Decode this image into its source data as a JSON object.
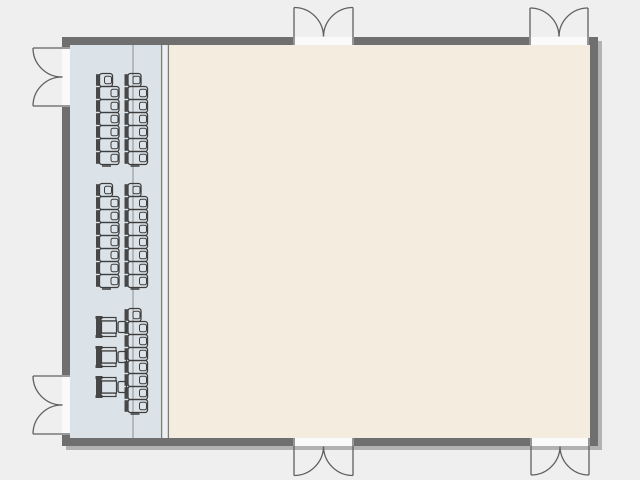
{
  "plan": {
    "canvas": {
      "width": 640,
      "height": 480,
      "background_color": "#efefef"
    },
    "room": {
      "outer": {
        "x": 62,
        "y": 37,
        "width": 536,
        "height": 409
      },
      "wall_thickness": 8,
      "wall_color": "#6f6f6f",
      "shadow": {
        "dx": 4,
        "dy": 4,
        "color": "#b2b2b2"
      }
    },
    "areas": {
      "chair_storage_strip": {
        "x": 70,
        "y": 45,
        "width": 91,
        "height": 393,
        "color": "#dce3e8"
      },
      "partition_band": {
        "x": 161,
        "y": 45,
        "width": 8,
        "height": 393,
        "color": "#edf0f2",
        "edge_color": "#7d7d7d"
      },
      "main_hall": {
        "x": 169,
        "y": 45,
        "width": 421,
        "height": 393,
        "color": "#f4ecdf"
      },
      "strip_divider_line": {
        "x": 133,
        "color": "#8f8f8f"
      }
    },
    "doors": {
      "style": {
        "stroke": "#606060",
        "gap_fill": "#fafafa",
        "type": "double-swing-out"
      },
      "items": [
        {
          "id": "top-left",
          "wall": "top",
          "opening_start": 293,
          "opening_end": 354
        },
        {
          "id": "top-right",
          "wall": "top",
          "opening_start": 529,
          "opening_end": 589
        },
        {
          "id": "bottom-left",
          "wall": "bottom",
          "opening_start": 293,
          "opening_end": 354
        },
        {
          "id": "bottom-right",
          "wall": "bottom",
          "opening_start": 530,
          "opening_end": 590
        },
        {
          "id": "left-upper",
          "wall": "left",
          "opening_start": 47,
          "opening_end": 107
        },
        {
          "id": "left-lower",
          "wall": "left",
          "opening_start": 375,
          "opening_end": 435
        }
      ]
    },
    "furniture": {
      "style": {
        "stroke": "#3e3e3e",
        "back_fill": "#474747"
      },
      "stacked_chair_size": {
        "width": 24,
        "height": 14,
        "pitch": 13
      },
      "chair_stacks": [
        {
          "id": "stack-1",
          "x": 96,
          "y": 73,
          "count": 7
        },
        {
          "id": "stack-2",
          "x": 124.5,
          "y": 73,
          "count": 7
        },
        {
          "id": "stack-3",
          "x": 96,
          "y": 183,
          "count": 8
        },
        {
          "id": "stack-4",
          "x": 124.5,
          "y": 183,
          "count": 8
        },
        {
          "id": "stack-5",
          "x": 124.5,
          "y": 308,
          "count": 8
        }
      ],
      "armchair_size": {
        "width": 31,
        "height": 22
      },
      "armchairs": [
        {
          "id": "armchair-1",
          "x": 96,
          "y": 316
        },
        {
          "id": "armchair-2",
          "x": 96,
          "y": 346
        },
        {
          "id": "armchair-3",
          "x": 96,
          "y": 376
        }
      ]
    }
  }
}
